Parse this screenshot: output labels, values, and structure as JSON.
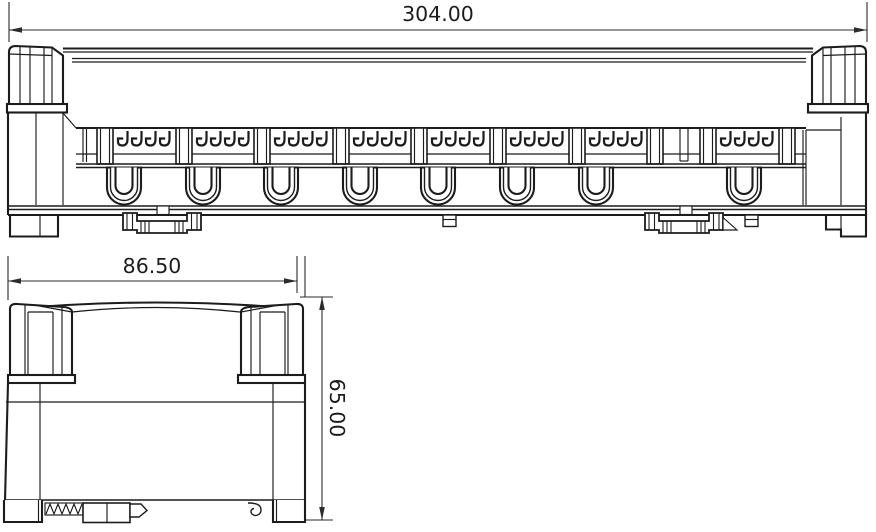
{
  "drawing": {
    "background_color": "#ffffff",
    "line_color": "#1c1c1c",
    "dimensions": {
      "front_width": "304.00",
      "side_width": "86.50",
      "side_height": "65.00"
    }
  }
}
